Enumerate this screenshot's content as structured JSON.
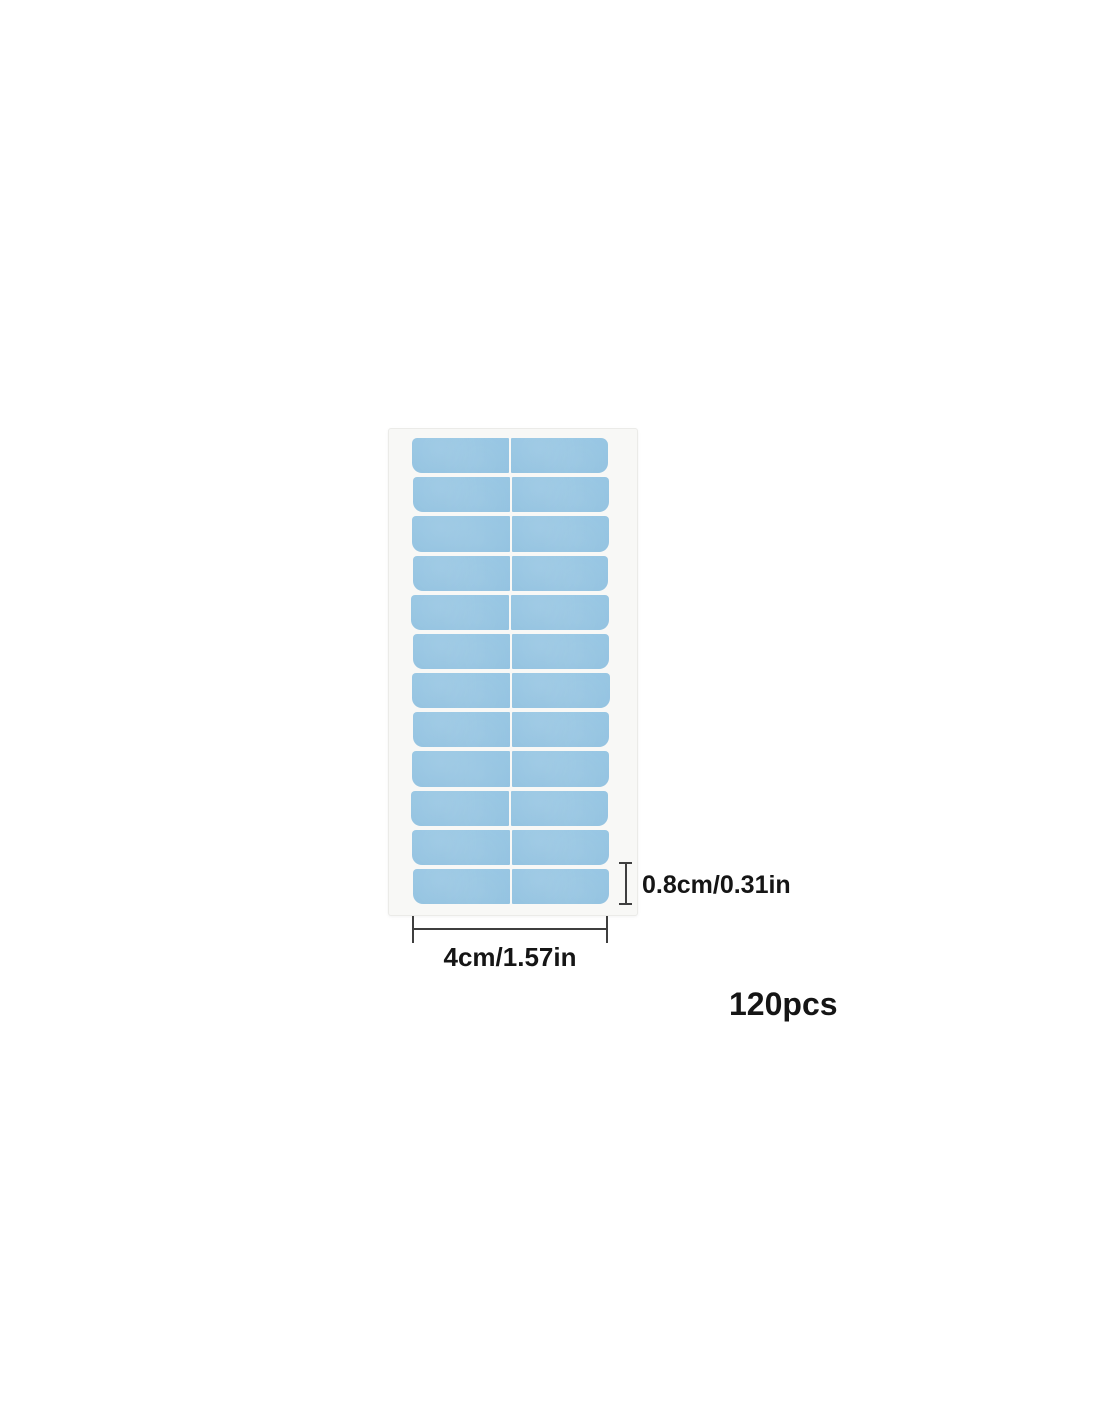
{
  "page": {
    "background_color": "#ffffff"
  },
  "diagram": {
    "sheet": {
      "rows": 12,
      "columns": 2,
      "total_tabs_visible": 24,
      "tab_color": "#92c2e0",
      "tab_color_light": "#97c6e3",
      "backing_color": "#f8f8f6"
    },
    "annotations": {
      "tab_height_label": "0.8cm/0.31in",
      "strip_width_label": "4cm/1.57in",
      "quantity_label": "120pcs"
    },
    "line_color": "#3f3f3f",
    "text_color": "#151515"
  }
}
